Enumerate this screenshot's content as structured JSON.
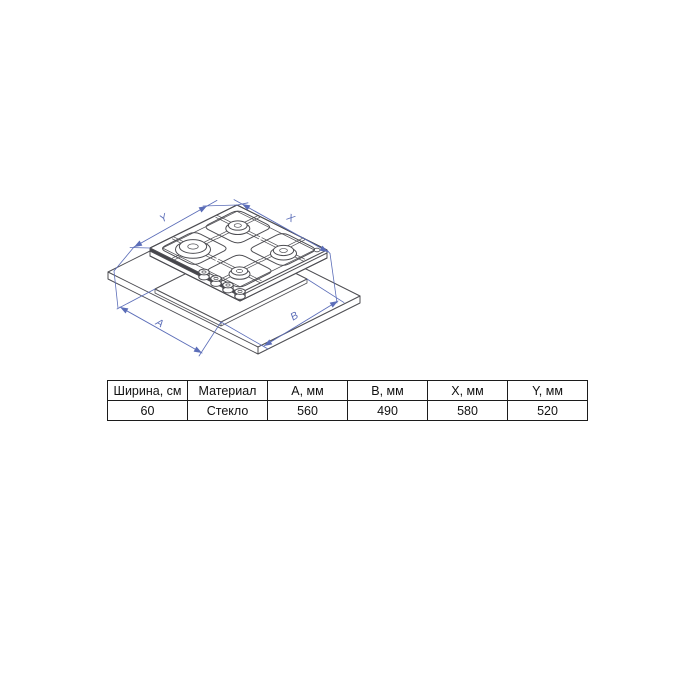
{
  "diagram": {
    "type": "isometric technical drawing",
    "subject": "4-burner gas hob installed in countertop cutout",
    "burner_count": 4,
    "knob_count": 4,
    "line_color": "#4d4d52",
    "dimension_color": "#5b6db8",
    "dimension_labels": {
      "top_left": "Y",
      "top_right": "X",
      "bottom_left": "A",
      "bottom_right": "B"
    }
  },
  "table": {
    "headers": [
      "Ширина, см",
      "Материал",
      "A, мм",
      "B, мм",
      "X, мм",
      "Y, мм"
    ],
    "rows": [
      [
        "60",
        "Стекло",
        "560",
        "490",
        "580",
        "520"
      ]
    ]
  }
}
